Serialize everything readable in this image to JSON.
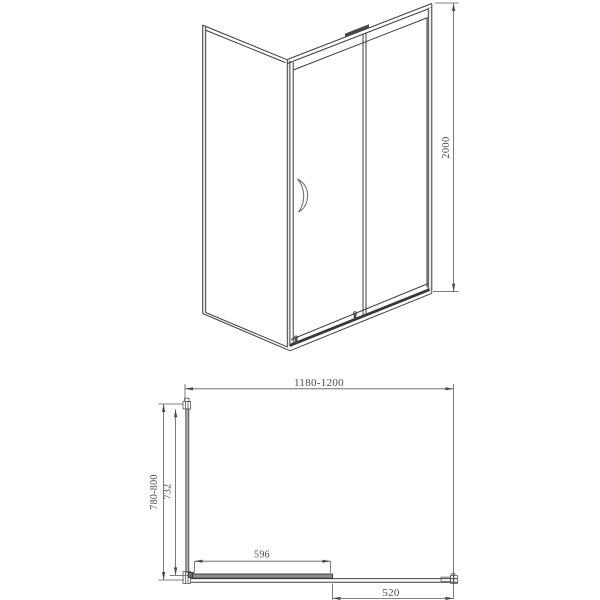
{
  "front_view": {
    "height_dim": "2000"
  },
  "plan_view": {
    "overall_width_dim": "1180-1200",
    "overall_depth_dim": "780-800",
    "side_panel_glass_dim": "732",
    "door_panel_dim": "596",
    "door_opening_dim": "520"
  }
}
